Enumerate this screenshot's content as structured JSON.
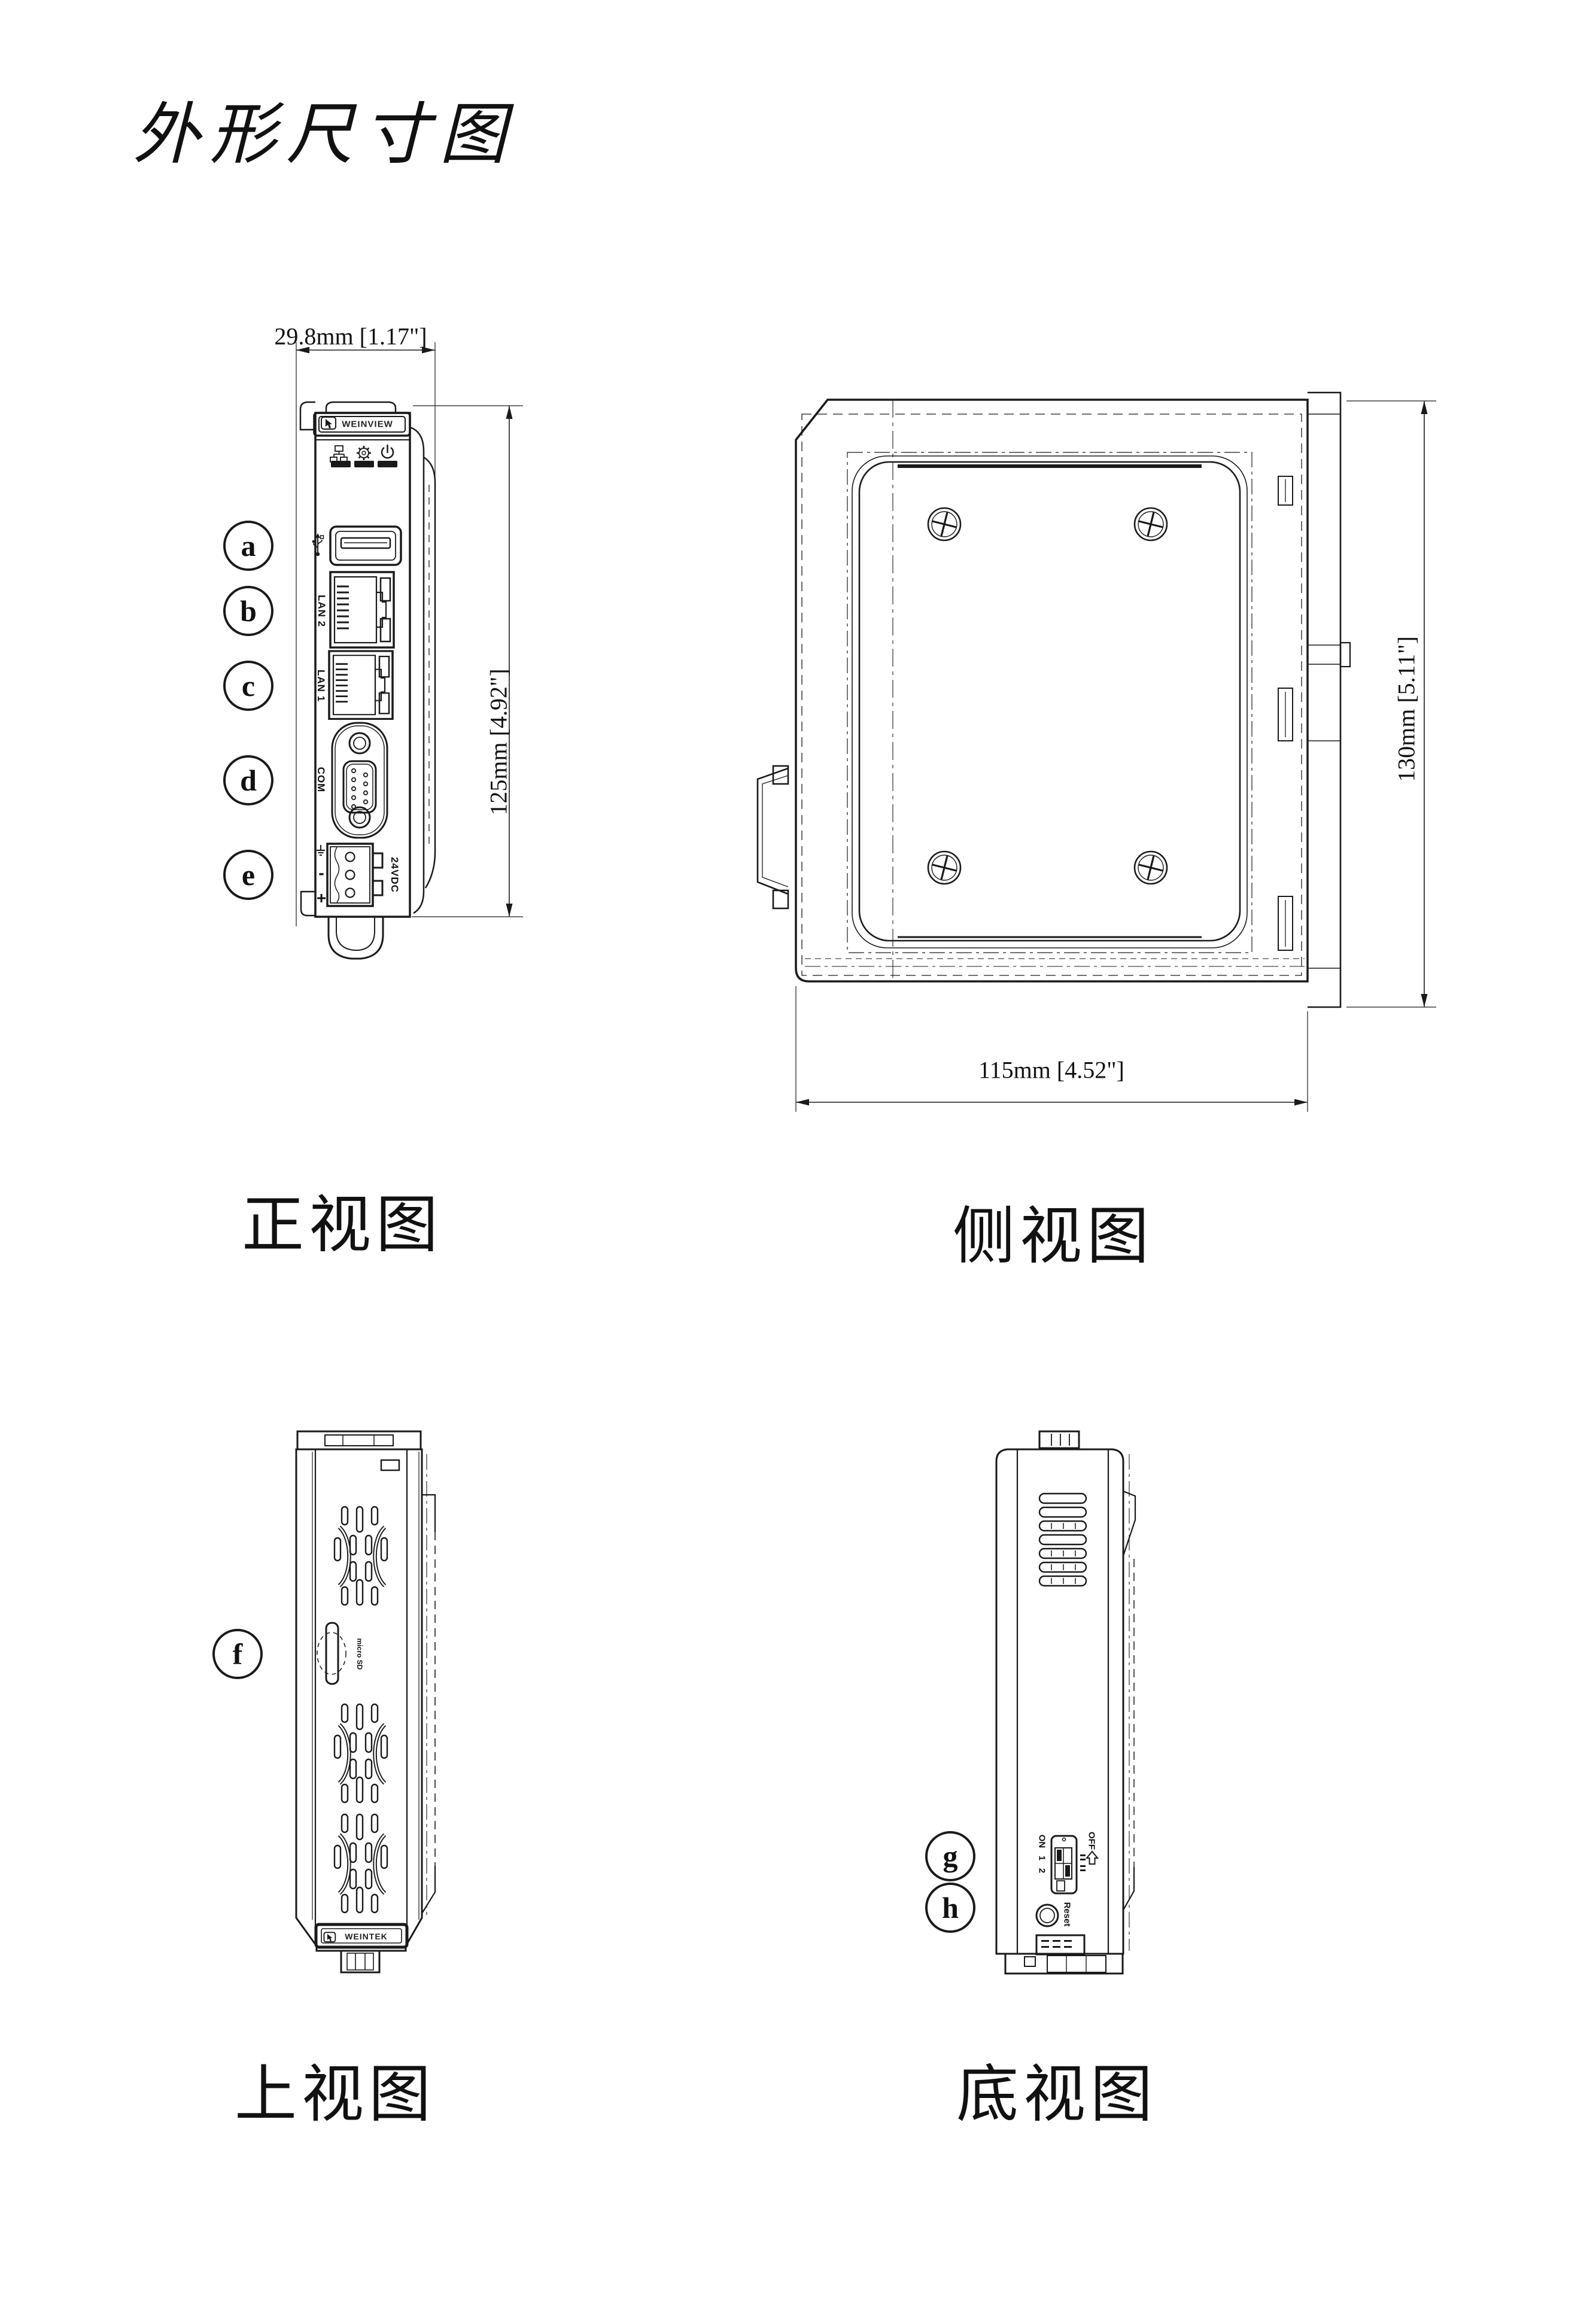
{
  "title": "外形尺寸图",
  "colors": {
    "line": "#1a1a1a",
    "background": "#ffffff"
  },
  "views": {
    "front": {
      "caption": "正视图",
      "width_dim": "29.8mm [1.17\"]",
      "height_dim": "125mm [4.92\"]",
      "brand": "WEINVIEW",
      "labels": {
        "lan2": "LAN 2",
        "lan1": "LAN 1",
        "com": "COM",
        "power": "24VDC",
        "minus": "-",
        "plus": "+"
      },
      "callouts": {
        "usb": "a",
        "lan2": "b",
        "lan1": "c",
        "com": "d",
        "power": "e"
      }
    },
    "side": {
      "caption": "侧视图",
      "height_dim": "130mm [5.11\"]",
      "width_dim": "115mm [4.52\"]"
    },
    "top": {
      "caption": "上视图",
      "sd_label": "micro SD",
      "brand": "WEINTEK",
      "callouts": {
        "sd": "f"
      }
    },
    "bottom": {
      "caption": "底视图",
      "dip": {
        "on": "ON",
        "sw1": "1",
        "sw2": "2",
        "off": "OFF"
      },
      "reset": "Reset",
      "callouts": {
        "dip": "g",
        "reset": "h"
      }
    }
  }
}
